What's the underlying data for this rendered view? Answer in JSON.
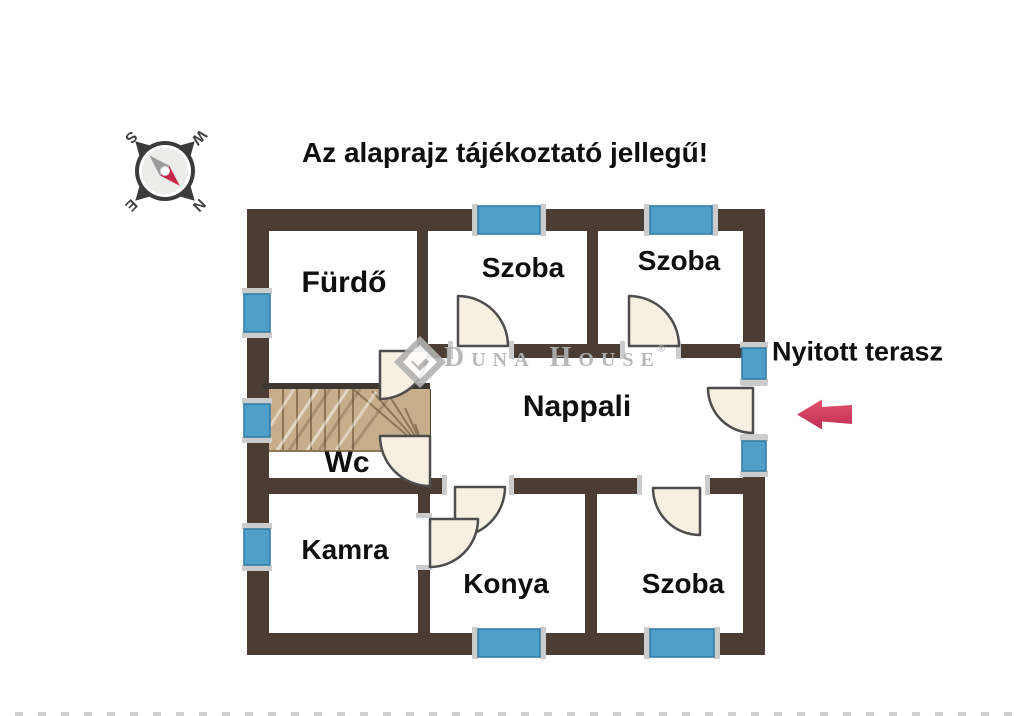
{
  "title": "Az alaprajz tájékoztató jellegű!",
  "terrace_label": "Nyitott terasz",
  "rooms": {
    "furdo": "Fürdő",
    "szoba_top_mid": "Szoba",
    "szoba_top_right": "Szoba",
    "nappali": "Nappali",
    "wc": "Wc",
    "kamra": "Kamra",
    "konya": "Konya",
    "szoba_bottom": "Szoba"
  },
  "compass": {
    "n": "N",
    "e": "E",
    "s": "S",
    "w": "W"
  },
  "watermark": {
    "name": "Duna House",
    "registered": "®"
  },
  "colors": {
    "wall": "#4b3d34",
    "stair_edge": "#3c3831",
    "window_blue": "#4f9fc8",
    "window_blue_border": "#2e7ba4",
    "door_fill": "#f6efe2",
    "door_stroke": "#4d4d4d",
    "wood": "#c7ae8a",
    "wood_line": "#8d7655",
    "arrow": "#d5405f",
    "watermark_gray": "#b2b2b2",
    "text_black": "#0f0f0f",
    "cap_gray": "#cccccc",
    "compass_dark": "#3b3b3b",
    "needle_red": "#c9264c",
    "needle_gray": "#9a9a9a"
  }
}
